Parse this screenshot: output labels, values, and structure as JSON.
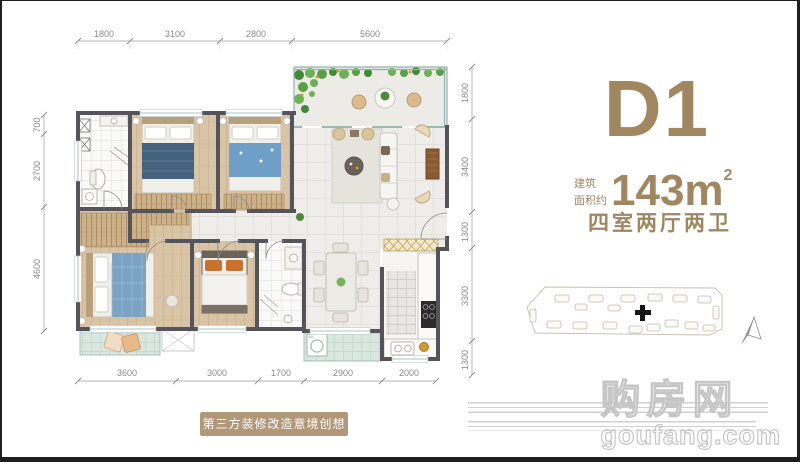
{
  "panel": {
    "unit_name": "D1",
    "area_label_line1": "建筑",
    "area_label_line2": "面积约",
    "area_value": "143m",
    "area_sup": "2",
    "layout": "四室两厅两卫"
  },
  "plan": {
    "dims_top": [
      "1800",
      "3100",
      "2800",
      "5600"
    ],
    "dims_bottom": [
      "3600",
      "3000",
      "1700",
      "2900",
      "2000"
    ],
    "dims_left": [
      "700",
      "2700",
      "4600"
    ],
    "dims_right": [
      "1800",
      "3400",
      "1300",
      "3300",
      "1300"
    ]
  },
  "caption": {
    "text": "第三方装修改造意境创想图"
  },
  "watermark": {
    "cn": "购房网",
    "en": "goufang.com"
  },
  "colors": {
    "accent_tan": "#a0875f",
    "caption_bg": "#b29778",
    "wall": "#54545a",
    "wood_floor": "#d9c5a6",
    "tile_floor": "#efede9",
    "balcony_tile": "#d9e7e1",
    "plant_green": "#57a043",
    "watermark_gray": "#c6c6c6"
  }
}
